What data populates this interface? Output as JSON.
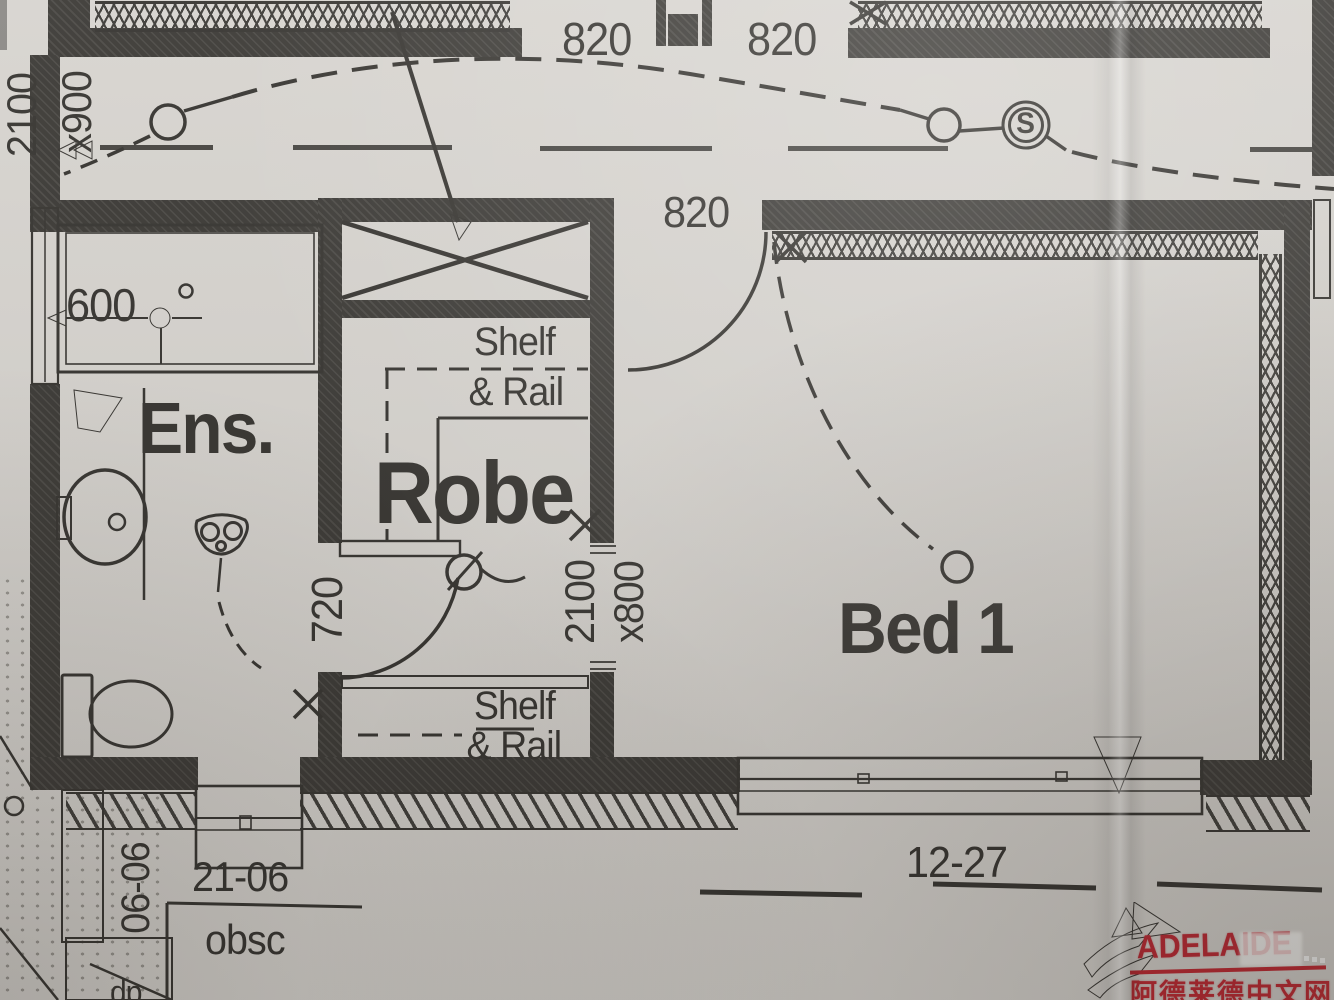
{
  "colors": {
    "ink": "#35332f",
    "paper": "#d7d4cf",
    "watermark_red": "#c2242e",
    "watermark_orange": "#e8772e"
  },
  "rooms": {
    "ensuite": "Ens.",
    "robe": "Robe",
    "bed1": "Bed 1"
  },
  "closets": {
    "upper": {
      "line1": "Shelf",
      "line2": "& Rail"
    },
    "lower": {
      "line1": "Shelf",
      "line2": "& Rail"
    }
  },
  "dimensions": {
    "hall_door_height": "2100",
    "hall_door_width": "x900",
    "door_820_left": "820",
    "door_820_right": "820",
    "door_820_bed1": "820",
    "vanity_width": "600",
    "robe_wall": "720",
    "robe_door_height": "2100",
    "robe_door_width": "x800"
  },
  "windows": {
    "ens_side": "06-06",
    "ens_front": "21-06",
    "ens_glazing": "obsc",
    "bed1_front": "12-27"
  },
  "annotations": {
    "downpipe": "dp",
    "smoke_alarm": "S"
  },
  "watermark": {
    "brand": "ADELAIDE",
    "site_name": "阿德莱德中文网"
  }
}
